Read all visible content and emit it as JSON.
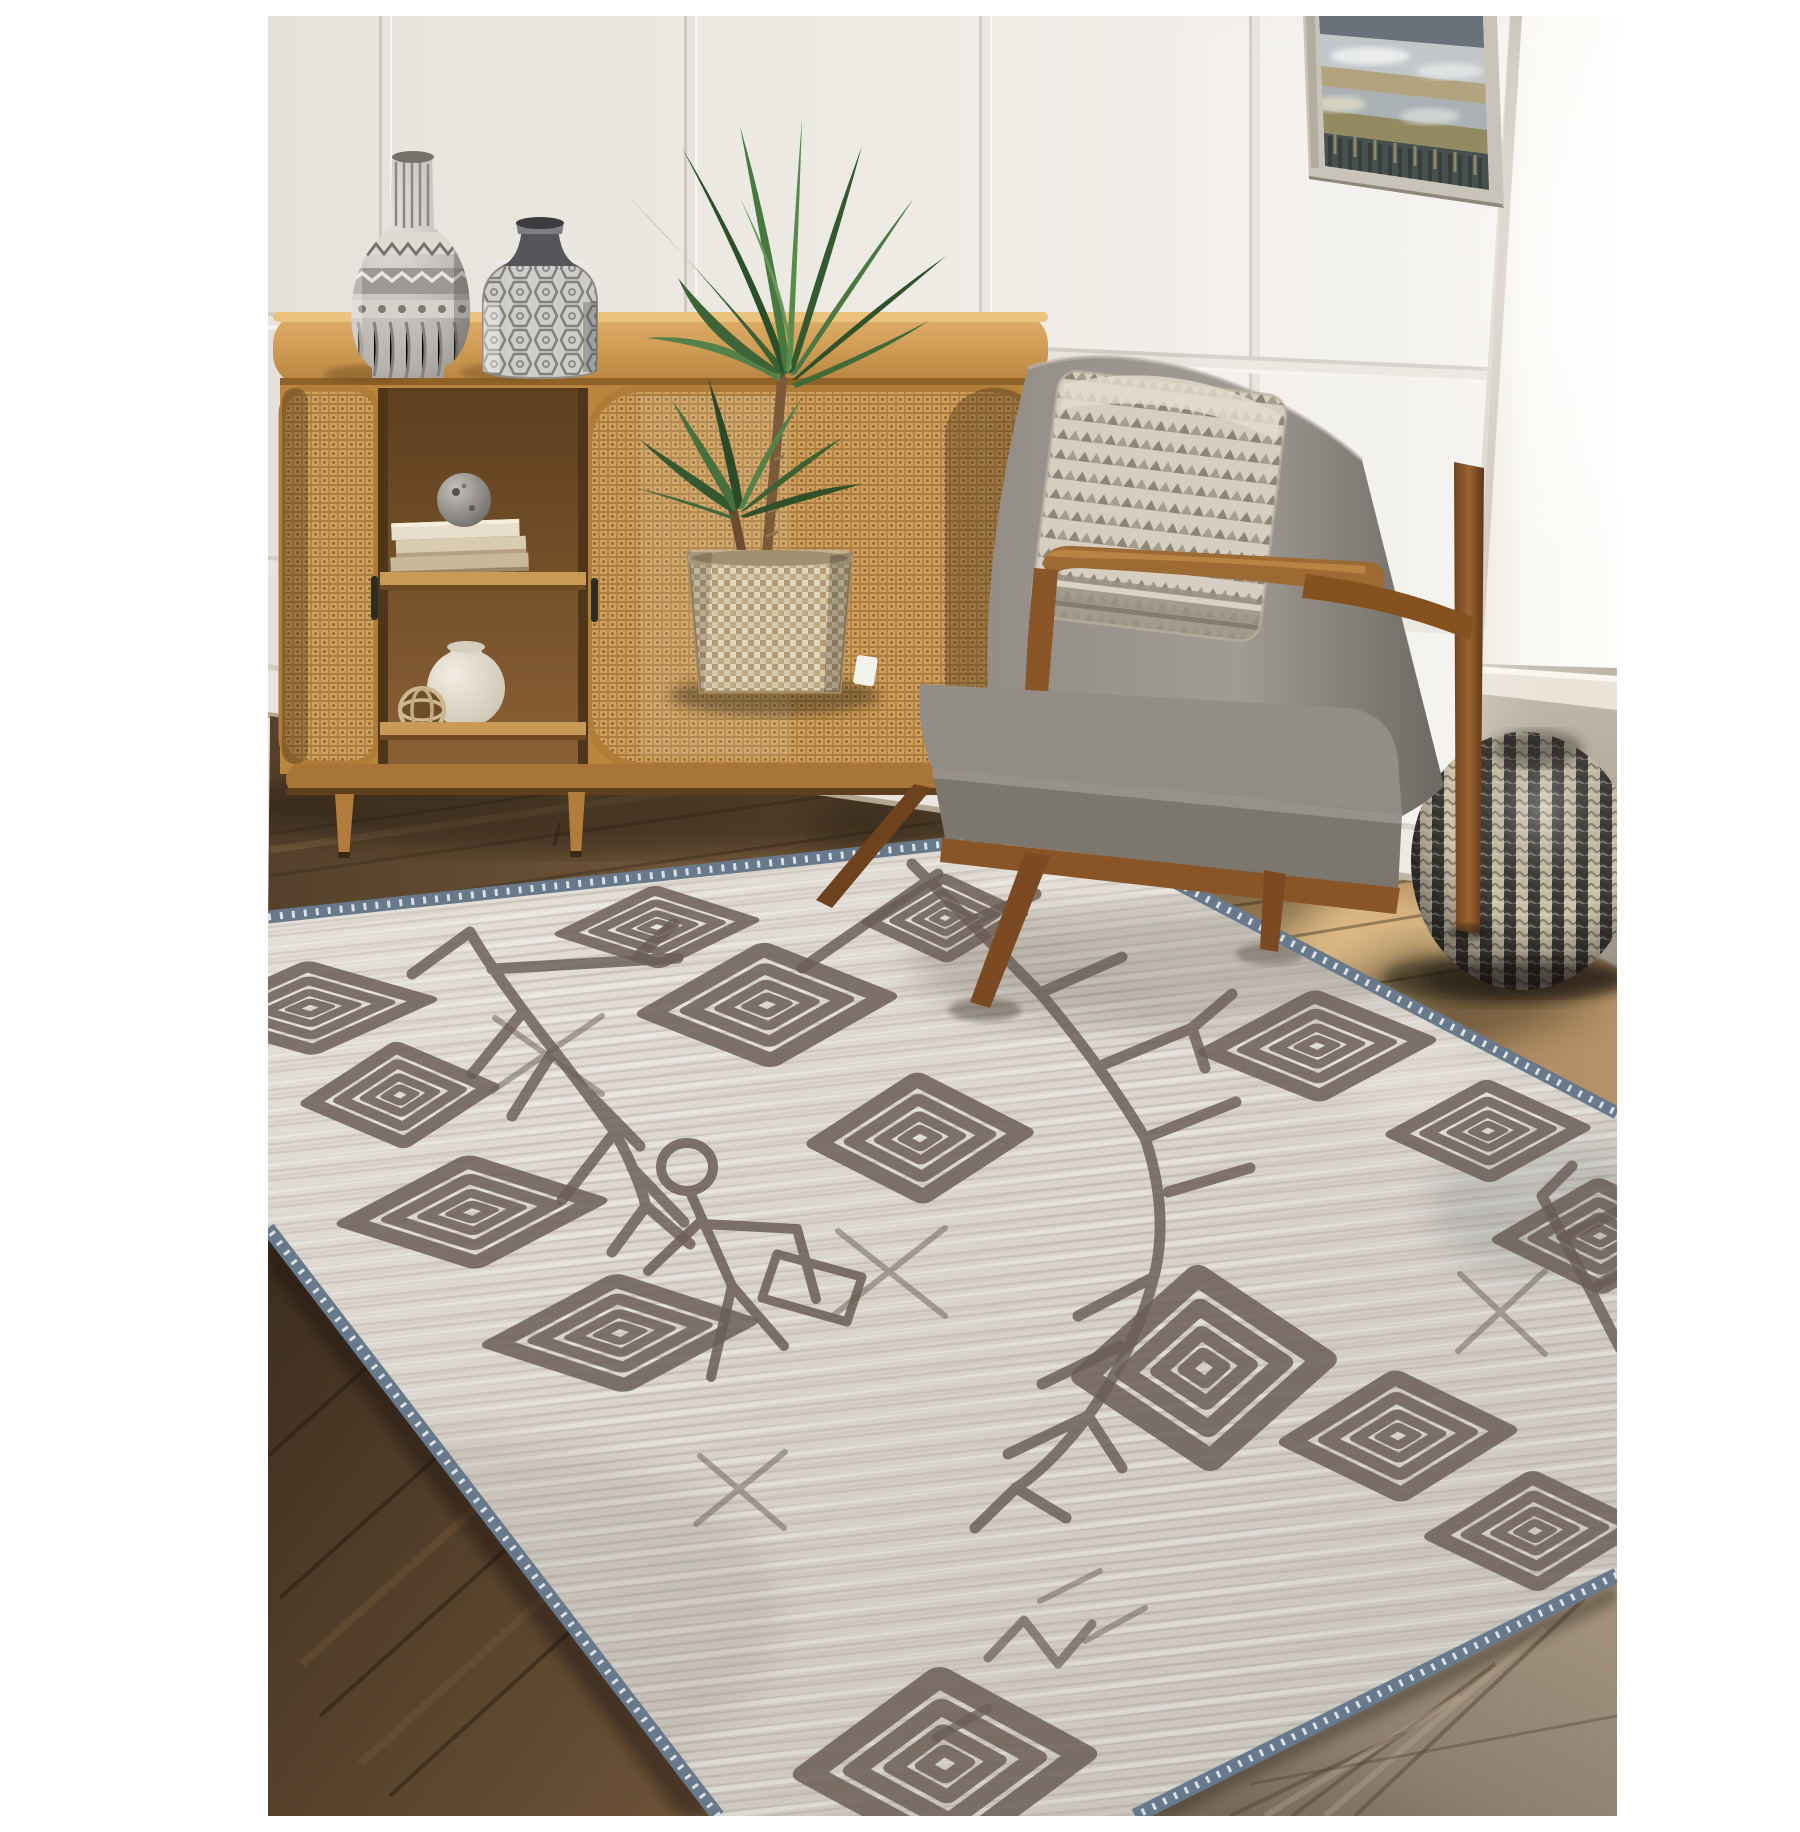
{
  "scene": {
    "alt": "Product photo: light grey Moroccan-style area rug with hand-drawn charcoal diamond, branch and stick-figure motifs and a slate-blue serged zigzag edge, staged in a living room with a white panelled wall, rattan sideboard with silver vases, yucca plant in a woven basket, walnut mid-century armchair with textured pillow, knitted two-tone pouf, abstract framed art and warm wood floors",
    "caption": "Bohemian tribal rug staged in a bright living room",
    "objects": [
      {
        "name": "area-rug",
        "description": "grey heathered rug, charcoal concentric diamonds, fir-branch motifs, stick figure, blue serged zigzag border"
      },
      {
        "name": "sideboard",
        "description": "oak oval cabinet with woven cane doors, open shelf with books, mosaic sphere, white gourd vase, wicker ball"
      },
      {
        "name": "tall-vase",
        "description": "silver etched bottle vase"
      },
      {
        "name": "short-vase",
        "description": "silver hexagon-etched vase"
      },
      {
        "name": "yucca-plant",
        "description": "potted yucca in two-tone woven basket with white tag"
      },
      {
        "name": "armchair",
        "description": "walnut frame, grey upholstery, cream geometric accent pillow"
      },
      {
        "name": "pouf",
        "description": "charcoal and cream knitted round pouf"
      },
      {
        "name": "wall-art",
        "description": "abstract landscape in champagne frame"
      },
      {
        "name": "window",
        "description": "bright daylight window with sill"
      },
      {
        "name": "floor",
        "description": "brown hardwood planks, sunlit patch, grey-washed planks at lower right"
      }
    ],
    "palette": {
      "photo_margin": "#ffffff",
      "wall": "#efebe5",
      "right_wall": "#c6bfb3",
      "window_light": "#faf8f3",
      "rug_field": "#dbd6ce",
      "rug_motif": "#6b5e55",
      "rug_serge_blue": "#67798a",
      "rug_serge_stitch": "#e8ecee",
      "floor_dark": "#5e4831",
      "floor_mid": "#7b5e40",
      "floor_sunlit": "#c9a06b",
      "floor_grey_wash": "#9a8d7d",
      "cabinet_wood": "#c99a55",
      "cane": "#cf9f5c",
      "chair_wood": "#8a5526",
      "upholstery": "#8f8a84",
      "pillow": "#d6cfc1",
      "pouf_dark": "#3e3d39",
      "pouf_cream": "#cdc1a9",
      "plant_green": "#4a7446",
      "basket": "#d6c9ab",
      "frame": "#c9c4b9"
    }
  }
}
